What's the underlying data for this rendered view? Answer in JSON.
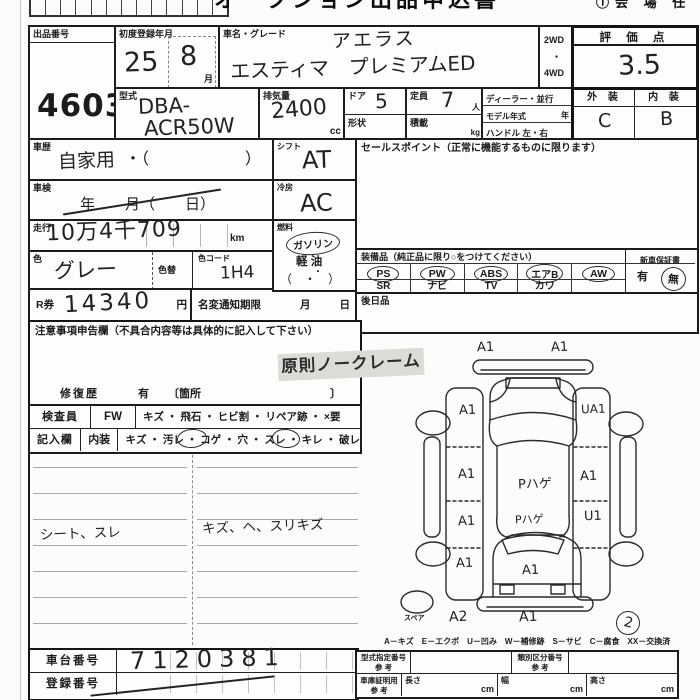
{
  "header": {
    "title_partial": "オークション出品申込書",
    "corner_note": "①会 場 任"
  },
  "lot": {
    "label": "出品番号",
    "value": "4603"
  },
  "first_reg": {
    "label": "初度登録年月",
    "year": "25",
    "month": "8",
    "month_unit": "月"
  },
  "vehicle": {
    "label": "車名・グレード",
    "grade_hand": "アエラス",
    "name_hand": "エスティマ　プレミアムED",
    "drive_top": "2WD",
    "drive_dot": "・",
    "drive_bottom": "4WD"
  },
  "score": {
    "label": "評 価 点",
    "value": "3.5"
  },
  "model_code": {
    "label": "型式",
    "line1": "DBA-",
    "line2": "ACR50W"
  },
  "displacement": {
    "label": "排気量",
    "value": "2400",
    "unit": "cc"
  },
  "doors": {
    "label": "ドア",
    "value": "5",
    "shape_label": "形状"
  },
  "capacity": {
    "label": "定員",
    "value": "7",
    "unit": "人",
    "load_label": "積載",
    "load_unit": "kg"
  },
  "dealer": {
    "line1": "ディーラー・並行",
    "line2": "モデル年式",
    "line2_unit": "年",
    "line3": "ハンドル 左・右"
  },
  "exterior_interior": {
    "ext_label": "外 装",
    "int_label": "内 装",
    "ext_value": "C",
    "int_value": "B"
  },
  "history": {
    "label": "車歴",
    "value": "自家用",
    "paren": "・（　　　　　　）"
  },
  "inspection": {
    "label": "車検",
    "text": "年　　月（　　日）"
  },
  "shift": {
    "label": "シフト",
    "value": "AT"
  },
  "cooling": {
    "label": "冷房",
    "value": "AC"
  },
  "mileage": {
    "label": "走行",
    "value": "10万4千709",
    "unit": "km"
  },
  "fuel": {
    "label": "燃料",
    "gasoline": "ガソリン",
    "diesel": "軽 油",
    "dot": "・",
    "paren": "（　・　）"
  },
  "color": {
    "label": "色",
    "value": "グレー",
    "change_label": "色替",
    "code_label": "色コード",
    "code_value": "1H4"
  },
  "r_ticket": {
    "label": "R券",
    "value": "14340",
    "unit": "円"
  },
  "name_change": {
    "label": "名変通知期限",
    "month": "月",
    "day": "日"
  },
  "sales_point": {
    "label": "セールスポイント（正常に機能するものに限ります）"
  },
  "equipment": {
    "label": "装備品（純正品に限り○をつけてください）",
    "row1": [
      "PS",
      "PW",
      "ABS",
      "エアB",
      "AW"
    ],
    "row2": [
      "SR",
      "ナビ",
      "TV",
      "カワ"
    ],
    "warranty_label": "新車保証書",
    "warranty_yes": "有",
    "warranty_no": "無"
  },
  "later_goods": {
    "label": "後日品"
  },
  "notice": {
    "label": "注意事項申告欄（不具合内容等は具体的に記入して下さい）",
    "stamp": "原則ノークレーム",
    "repair_label": "修復歴",
    "repair_opt": "有",
    "repair_open": "〔箇所",
    "repair_close": "〕"
  },
  "inspector": {
    "row_label1": "検査員",
    "row_label2": "記入欄",
    "cat1": "FW",
    "cat2": "内装",
    "items1": "キズ ・ 飛石 ・ ヒビ割 ・ リペア跡 ・ ×要",
    "items2": "キズ ・ 汚レ ・ コゲ ・ 穴 ・ スレ ・ キレ ・ 破レ"
  },
  "notes": {
    "left": "シート、スレ",
    "right": "キズ、ヘ、スリキズ"
  },
  "diagram": {
    "marks": {
      "front_bumper_left": "A1",
      "front_bumper_right": "A1",
      "left_front_fender": "A1",
      "right_front_fender": "UA1",
      "left_front_door": "A1",
      "hood_center": "Pハゲ",
      "right_front_door": "A1",
      "left_rear_door": "A1",
      "roof_rear": "Pハゲ",
      "right_rear_door": "U1",
      "left_rear_quarter": "A1",
      "rear_gate": "A1",
      "rear_bumper_left": "A2",
      "rear_bumper_center": "A1"
    },
    "spare_label": "スペア",
    "page_no": "2",
    "legend": "A－キズ　E－エクボ　U－凹み　W－補修跡　S－サビ　C－腐食　XX－交換済"
  },
  "chassis": {
    "label": "車台番号",
    "value": "7120381"
  },
  "plate": {
    "label": "登録番号"
  },
  "ref_table": {
    "type_label": "型式指定番号",
    "type_ref": "参 考",
    "class_label": "類別区分番号",
    "class_ref": "参 考",
    "garage_label": "車庫証明用",
    "garage_ref": "参 考",
    "length_label": "長さ",
    "width_label": "幅",
    "height_label": "高さ",
    "cm": "cm"
  }
}
